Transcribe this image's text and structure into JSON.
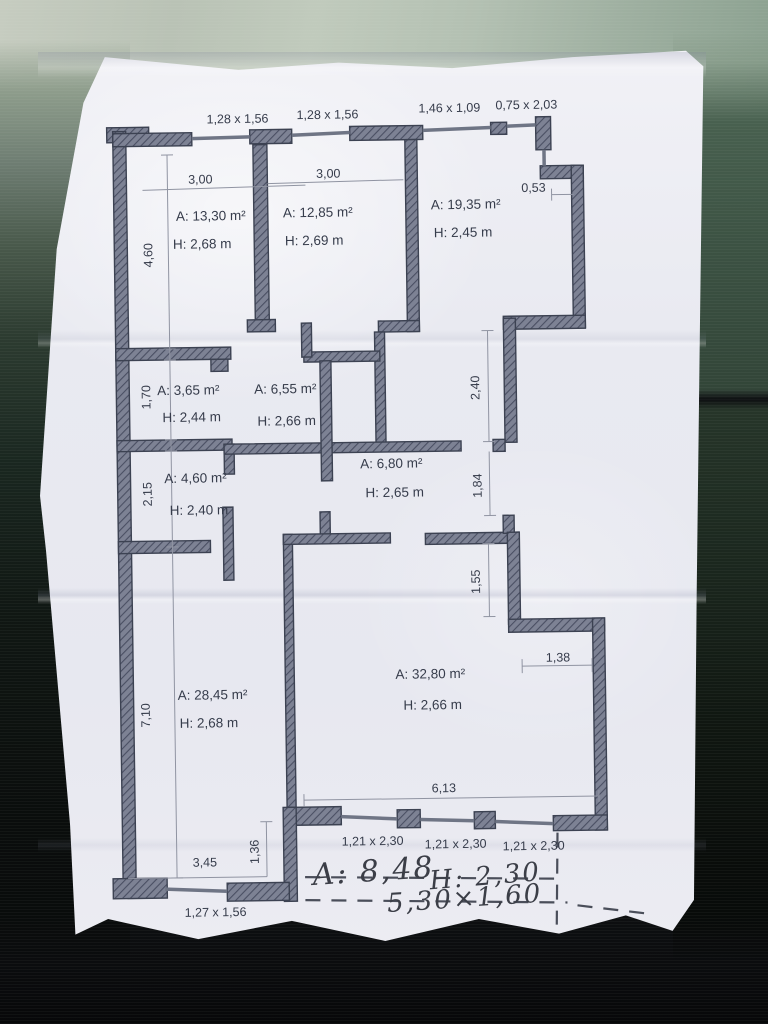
{
  "plan": {
    "window_dimensions_top": [
      "1,28 x 1,56",
      "1,28 x 1,56",
      "1,46 x 1,09",
      "0,75 x 2,03"
    ],
    "rooms": [
      {
        "name": "top-left-room",
        "area_label": "A: 13,30 m²",
        "height_label": "H: 2,68 m"
      },
      {
        "name": "top-middle-room",
        "area_label": "A: 12,85 m²",
        "height_label": "H: 2,69 m"
      },
      {
        "name": "top-right-room",
        "area_label": "A: 19,35 m²",
        "height_label": "H: 2,45 m"
      },
      {
        "name": "storage-room",
        "area_label": "A: 3,65 m²",
        "height_label": "H: 2,44 m"
      },
      {
        "name": "corridor",
        "area_label": "A: 6,55 m²",
        "height_label": "H: 2,66 m"
      },
      {
        "name": "bathroom",
        "area_label": "A: 4,60 m²",
        "height_label": "H: 2,40 m"
      },
      {
        "name": "hall",
        "area_label": "A: 6,80 m²",
        "height_label": "H: 2,65 m"
      },
      {
        "name": "bottom-left-room",
        "area_label": "A: 28,45 m²",
        "height_label": "H: 2,68 m"
      },
      {
        "name": "living-room",
        "area_label": "A: 32,80 m²",
        "height_label": "H: 2,66 m"
      }
    ],
    "dimensions": {
      "room1_width": "3,00",
      "room2_width": "3,00",
      "room1_depth": "4,60",
      "niche_top_right": "0,53",
      "storage_depth": "1,70",
      "bathroom_depth": "2,15",
      "corridor_right": "2,40",
      "hall_right": "1,84",
      "living_right": "1,55",
      "living_niche": "1,38",
      "living_width": "6,13",
      "bottom_left_width": "3,45",
      "bottom_step": "1,36",
      "bottom_left_depth": "7,10",
      "window_bottom_left": "1,27 x 1,56",
      "living_windows": [
        "1,21 x 2,30",
        "1,21 x 2,30",
        "1,21 x 2,30"
      ]
    },
    "balcony_handwritten": {
      "area": "A: 8,48",
      "height": "H: 2,30",
      "size": "5,30×1,60"
    }
  },
  "colors": {
    "paper": "#e9eaf1",
    "wall_fill": "#7d8294",
    "wall_hatch": "#4a4f63",
    "wall_outline": "#3c4252",
    "window_line": "#6f7585",
    "dimension_line": "#9094a2",
    "text": "#363c4b",
    "handwriting": "#3b3e47",
    "background_fabric_green": "#35493c",
    "background_sage": "#b7c2b4",
    "background_dark": "#0d0f11"
  }
}
